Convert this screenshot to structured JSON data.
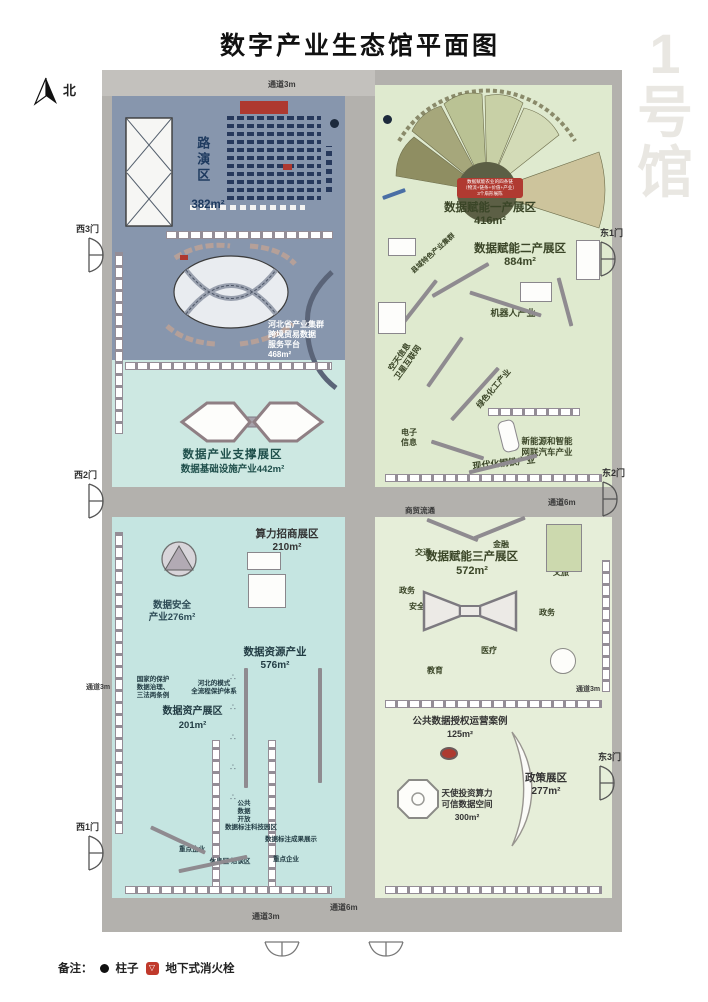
{
  "header": {
    "title": "数字产业生态馆平面图",
    "hall_label": "1号馆",
    "north_label": "北"
  },
  "aisles": {
    "top": "通道3m",
    "center": "通道6m",
    "left": "通道3m",
    "right": "通道3m",
    "bottom_left": "通道3m",
    "bottom_center": "通道6m",
    "commerce": "商贸流通"
  },
  "doors": {
    "west": [
      "西3门",
      "西2门",
      "西1门"
    ],
    "east": [
      "东1门",
      "东2门",
      "东3门"
    ]
  },
  "northwest": {
    "roadshow_name": "路演区",
    "roadshow_area": "382m²",
    "platform": "河北省产业集群\n跨境贸易数据\n服务平台\n468m²",
    "support_name": "数据产业支撑展区",
    "support_sub": "数据基础设施产业442m²"
  },
  "northeast": {
    "fan_banner": "数据赋能农业的四条链\n（物流+链条+价值+产业）\n3个扇形展陈",
    "primary_name": "数据赋能一产展区",
    "primary_area": "416m²",
    "secondary_name": "数据赋能二产展区",
    "secondary_area": "884m²",
    "county": "县域特色产业集群",
    "robot": "机器人产业",
    "aerospace": "空天信息\n卫星互联网",
    "chemical": "绿色化工产业",
    "electronics": "电子\n信息",
    "ev": "新能源和智能\n网联汽车产业",
    "steel": "现代化钢铁产业"
  },
  "southwest": {
    "computing_name": "算力招商展区",
    "computing_area": "210m²",
    "security": "数据安全\n产业276m²",
    "resource_name": "数据资源产业",
    "resource_area": "576m²",
    "asset_name": "数据资产展区",
    "asset_area": "201m²",
    "protect_national": "国家的保护\n数据治理、\n三法两条例",
    "protect_hebei": "河北的模式\n全流程保护体系",
    "notes": [
      "公共数据开放",
      "数据标注科技园区",
      "数据标注成果展示",
      "重点企业",
      "休息区 洽谈区"
    ]
  },
  "southeast": {
    "tertiary_name": "数据赋能三产展区",
    "tertiary_area": "572m²",
    "sectors": [
      "交通",
      "金融",
      "政务",
      "安全",
      "文旅",
      "医疗",
      "教育"
    ],
    "public_name": "公共数据授权运营案例",
    "public_area": "125m²",
    "policy_name": "政策展区",
    "policy_area": "277m²",
    "angel": "天使投资算力\n可信数据空间",
    "angel_area": "300m²"
  },
  "legend": {
    "prefix": "备注：",
    "pillar": "柱子",
    "hydrant": "地下式消火栓"
  }
}
